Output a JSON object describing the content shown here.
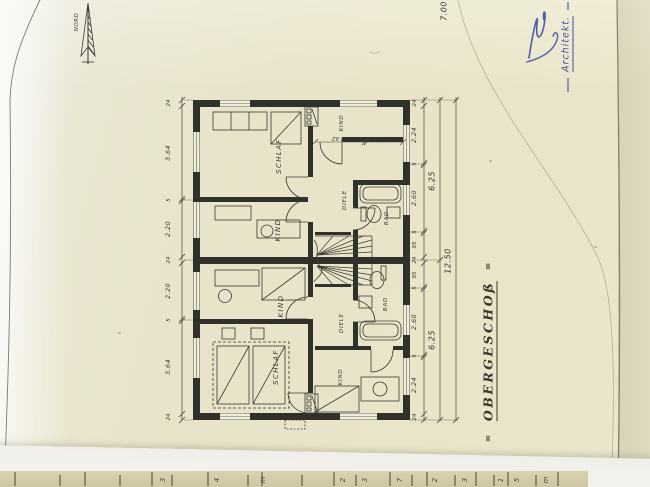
{
  "labels": {
    "title": "OBERGESCHOß",
    "title_flank": "=",
    "architect": "Architekt.",
    "north": "NORD",
    "overall_width": "7.00",
    "overall_length": "12.50"
  },
  "rooms_upper": {
    "schlaf": "SCHLAF",
    "kind_left": "KIND",
    "kind_small": "KIND",
    "diele": "DIELE",
    "bad": "BAD"
  },
  "rooms_lower": {
    "kind_left": "KIND",
    "schlaf": "SCHLAF",
    "kind_right": "KIND",
    "diele": "DIELE",
    "bad": "BAD"
  },
  "dims": {
    "left_chain": [
      "24",
      "3.64",
      "5",
      "2.20",
      "24",
      "2.20",
      "5",
      "3.64",
      "24"
    ],
    "right_chain": [
      "24",
      "2.24",
      "5",
      "2.60",
      "5",
      "95",
      "24",
      "95",
      "5",
      "2.60",
      "5",
      "2.24",
      "24"
    ],
    "right_totals": [
      "6.25",
      "6.25"
    ],
    "kind_inner": [
      "2.62",
      "5",
      "1.90"
    ]
  },
  "ruler": {
    "digits": [
      "3",
      "4",
      "m",
      "2",
      "3",
      "7",
      "2",
      "3",
      "1",
      "5",
      "m"
    ]
  },
  "colors": {
    "ink": "#3b3933",
    "wall": "#32302b",
    "blue": "#3d51a5"
  }
}
